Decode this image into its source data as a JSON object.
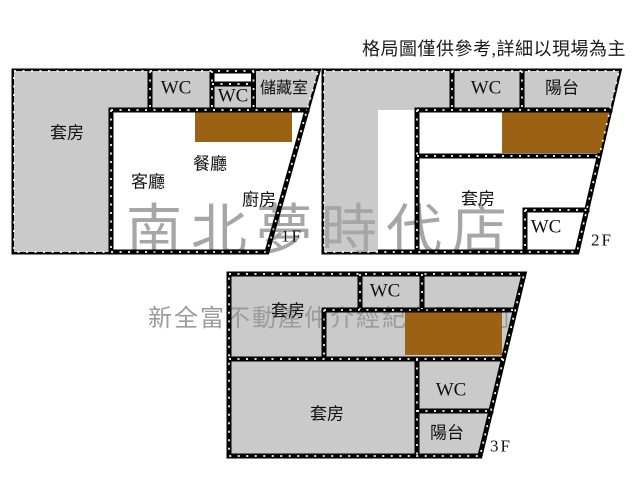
{
  "disclaimer": "格局圖僅供參考,詳細以現場為主",
  "watermarks": {
    "store": "南北夢時代店",
    "company": "新全富不動產仲介經紀有限公司"
  },
  "colors": {
    "floor_bg": "#ffffff",
    "room_fill": "#cacaca",
    "stairs_fill": "#9c6213",
    "wall": "#000000",
    "watermark_store": "#a6a6a6",
    "watermark_company": "#9b9b9b"
  },
  "floors": [
    {
      "label": "1F",
      "rooms": [
        {
          "label": "套房"
        },
        {
          "label": "WC"
        },
        {
          "label": "WC"
        },
        {
          "label": "儲藏室"
        },
        {
          "label": "餐廳"
        },
        {
          "label": "客廳"
        },
        {
          "label": "廚房"
        }
      ]
    },
    {
      "label": "2F",
      "rooms": [
        {
          "label": "WC"
        },
        {
          "label": "陽台"
        },
        {
          "label": "套房"
        },
        {
          "label": "WC"
        }
      ]
    },
    {
      "label": "3F",
      "rooms": [
        {
          "label": "套房"
        },
        {
          "label": "WC"
        },
        {
          "label": "套房"
        },
        {
          "label": "WC"
        },
        {
          "label": "陽台"
        }
      ]
    }
  ]
}
